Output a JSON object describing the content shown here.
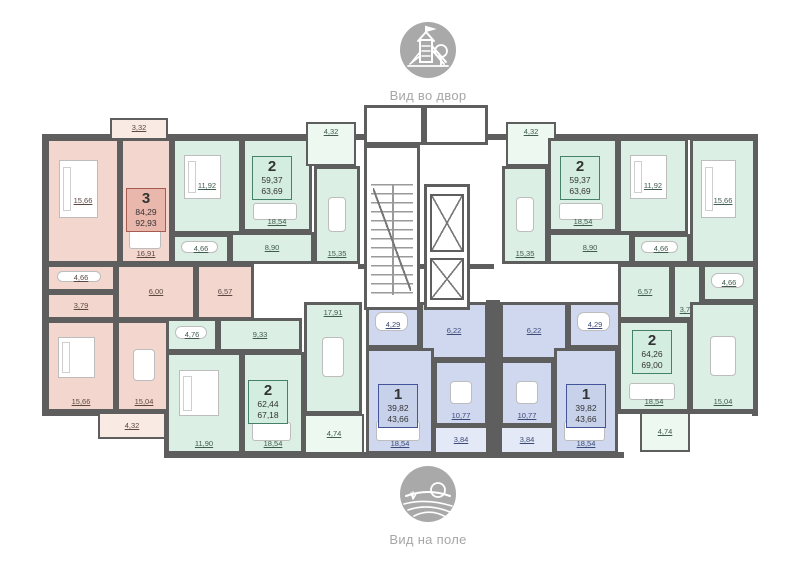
{
  "header_icon": {
    "caption": "Вид во двор"
  },
  "footer_icon": {
    "caption": "Вид на поле"
  },
  "wall_color": "#5e5e5e",
  "palettes": {
    "pink": {
      "room": "#f3d7ce",
      "balcony": "#f9eae4",
      "box_fill": "#e9b7ab",
      "box_border": "#a55c4f",
      "text": "#5c4742"
    },
    "green": {
      "room": "#dcefe4",
      "balcony": "#edf8f1",
      "box_fill": "#d3edе0",
      "box_fill2": "#d3ede0",
      "box_border": "#44806a",
      "text": "#3f5c50"
    },
    "blue": {
      "room": "#cfd8ee",
      "balcony": "#e3e9f6",
      "box_fill": "#c7d2ea",
      "box_border": "#44549a",
      "text": "#3c4a78"
    }
  },
  "apartments": [
    {
      "id": "apt-3-left",
      "type": "3",
      "area_living": "84,29",
      "area_total": "92,93",
      "palette": "pink",
      "info_box": {
        "x": 126,
        "y": 188
      },
      "rooms": [
        {
          "area": "3,32",
          "x": 110,
          "y": 118,
          "w": 58,
          "h": 24,
          "balcony": true,
          "lp": "t"
        },
        {
          "area": "15,66",
          "x": 46,
          "y": 138,
          "w": 74,
          "h": 126,
          "furn": "bed",
          "lp": "m"
        },
        {
          "area": "16,91",
          "x": 120,
          "y": 138,
          "w": 52,
          "h": 126,
          "furn": "sofa",
          "lp": "b"
        },
        {
          "area": "4,66",
          "x": 46,
          "y": 264,
          "w": 70,
          "h": 28,
          "furn": "tub",
          "lp": "m"
        },
        {
          "area": "3,79",
          "x": 46,
          "y": 292,
          "w": 70,
          "h": 28,
          "lp": "m"
        },
        {
          "area": "6,00",
          "x": 116,
          "y": 264,
          "w": 80,
          "h": 56,
          "lp": "m"
        },
        {
          "area": "6,57",
          "x": 196,
          "y": 264,
          "w": 58,
          "h": 56,
          "lp": "m"
        },
        {
          "area": "15,66",
          "x": 46,
          "y": 320,
          "w": 70,
          "h": 92,
          "furn": "bed",
          "lp": "b"
        },
        {
          "area": "15,04",
          "x": 116,
          "y": 320,
          "w": 56,
          "h": 92,
          "furn": "table",
          "lp": "b"
        },
        {
          "area": "4,32",
          "x": 98,
          "y": 412,
          "w": 68,
          "h": 27,
          "balcony": true,
          "lp": "m"
        }
      ]
    },
    {
      "id": "apt-2-top-left",
      "type": "2",
      "area_living": "59,37",
      "area_total": "63,69",
      "palette": "green",
      "info_box": {
        "x": 252,
        "y": 156
      },
      "rooms": [
        {
          "area": "11,92",
          "x": 172,
          "y": 138,
          "w": 70,
          "h": 96,
          "furn": "bed",
          "lp": "m"
        },
        {
          "area": "4,66",
          "x": 172,
          "y": 234,
          "w": 58,
          "h": 30,
          "furn": "tub",
          "lp": "m"
        },
        {
          "area": "18,54",
          "x": 242,
          "y": 138,
          "w": 70,
          "h": 94,
          "furn": "sofa",
          "lp": "b"
        },
        {
          "area": "8,90",
          "x": 230,
          "y": 232,
          "w": 84,
          "h": 32,
          "lp": "m"
        },
        {
          "area": "15,35",
          "x": 314,
          "y": 166,
          "w": 46,
          "h": 98,
          "furn": "table",
          "lp": "b"
        },
        {
          "area": "4,32",
          "x": 306,
          "y": 122,
          "w": 50,
          "h": 44,
          "balcony": true,
          "lp": "t"
        }
      ]
    },
    {
      "id": "apt-2-bottom-left",
      "type": "2",
      "area_living": "62,44",
      "area_total": "67,18",
      "palette": "green",
      "info_box": {
        "x": 248,
        "y": 380
      },
      "rooms": [
        {
          "area": "4,76",
          "x": 166,
          "y": 318,
          "w": 52,
          "h": 34,
          "furn": "tub",
          "lp": "m"
        },
        {
          "area": "9,33",
          "x": 218,
          "y": 318,
          "w": 84,
          "h": 34,
          "lp": "m"
        },
        {
          "area": "11,90",
          "x": 166,
          "y": 352,
          "w": 76,
          "h": 102,
          "furn": "bed",
          "lp": "b"
        },
        {
          "area": "18,54",
          "x": 242,
          "y": 352,
          "w": 62,
          "h": 102,
          "furn": "sofa",
          "lp": "b"
        },
        {
          "area": "17,91",
          "x": 304,
          "y": 302,
          "w": 58,
          "h": 112,
          "furn": "table",
          "lp": "t"
        },
        {
          "area": "4,74",
          "x": 304,
          "y": 414,
          "w": 60,
          "h": 40,
          "balcony": true,
          "lp": "m"
        }
      ]
    },
    {
      "id": "apt-1-left",
      "type": "1",
      "area_living": "39,82",
      "area_total": "43,66",
      "palette": "blue",
      "info_box": {
        "x": 378,
        "y": 384
      },
      "rooms": [
        {
          "area": "4,29",
          "x": 366,
          "y": 302,
          "w": 54,
          "h": 46,
          "furn": "tub",
          "lp": "m"
        },
        {
          "area": "6,22",
          "x": 420,
          "y": 302,
          "w": 68,
          "h": 58,
          "lp": "m"
        },
        {
          "area": "18,54",
          "x": 366,
          "y": 348,
          "w": 68,
          "h": 106,
          "furn": "sofa",
          "lp": "b"
        },
        {
          "area": "10,77",
          "x": 434,
          "y": 360,
          "w": 54,
          "h": 66,
          "furn": "table",
          "lp": "b"
        },
        {
          "area": "3,84",
          "x": 434,
          "y": 426,
          "w": 54,
          "h": 28,
          "balcony": true,
          "lp": "m"
        }
      ]
    },
    {
      "id": "apt-1-right",
      "type": "1",
      "area_living": "39,82",
      "area_total": "43,66",
      "palette": "blue",
      "info_box": {
        "x": 566,
        "y": 384
      },
      "rooms": [
        {
          "area": "6,22",
          "x": 500,
          "y": 302,
          "w": 68,
          "h": 58,
          "lp": "m"
        },
        {
          "area": "4,29",
          "x": 568,
          "y": 302,
          "w": 54,
          "h": 46,
          "furn": "tub",
          "lp": "m"
        },
        {
          "area": "10,77",
          "x": 500,
          "y": 360,
          "w": 54,
          "h": 66,
          "furn": "table",
          "lp": "b"
        },
        {
          "area": "18,54",
          "x": 554,
          "y": 348,
          "w": 64,
          "h": 106,
          "furn": "sofa",
          "lp": "b"
        },
        {
          "area": "3,84",
          "x": 500,
          "y": 426,
          "w": 54,
          "h": 28,
          "balcony": true,
          "lp": "m"
        }
      ]
    },
    {
      "id": "apt-2-top-right",
      "type": "2",
      "area_living": "59,37",
      "area_total": "63,69",
      "palette": "green",
      "info_box": {
        "x": 560,
        "y": 156
      },
      "rooms": [
        {
          "area": "4,32",
          "x": 506,
          "y": 122,
          "w": 50,
          "h": 44,
          "balcony": true,
          "lp": "t"
        },
        {
          "area": "15,35",
          "x": 502,
          "y": 166,
          "w": 46,
          "h": 98,
          "furn": "table",
          "lp": "b"
        },
        {
          "area": "18,54",
          "x": 548,
          "y": 138,
          "w": 70,
          "h": 94,
          "furn": "sofa",
          "lp": "b"
        },
        {
          "area": "8,90",
          "x": 548,
          "y": 232,
          "w": 84,
          "h": 32,
          "lp": "m"
        },
        {
          "area": "11,92",
          "x": 618,
          "y": 138,
          "w": 70,
          "h": 96,
          "furn": "bed",
          "lp": "m"
        },
        {
          "area": "4,66",
          "x": 632,
          "y": 234,
          "w": 58,
          "h": 30,
          "furn": "tub",
          "lp": "m"
        }
      ]
    },
    {
      "id": "apt-2-right",
      "type": "2",
      "area_living": "64,26",
      "area_total": "69,00",
      "palette": "green",
      "info_box": {
        "x": 632,
        "y": 330
      },
      "rooms": [
        {
          "area": "15,66",
          "x": 690,
          "y": 138,
          "w": 66,
          "h": 126,
          "furn": "bed",
          "lp": "m"
        },
        {
          "area": "4,66",
          "x": 702,
          "y": 264,
          "w": 54,
          "h": 38,
          "furn": "tub",
          "lp": "m"
        },
        {
          "area": "3,79",
          "x": 672,
          "y": 264,
          "w": 30,
          "h": 56,
          "lp": "b"
        },
        {
          "area": "6,57",
          "x": 618,
          "y": 264,
          "w": 54,
          "h": 56,
          "lp": "m"
        },
        {
          "area": "18,54",
          "x": 618,
          "y": 320,
          "w": 72,
          "h": 92,
          "furn": "sofa",
          "lp": "b"
        },
        {
          "area": "15,04",
          "x": 690,
          "y": 302,
          "w": 66,
          "h": 110,
          "furn": "table",
          "lp": "b"
        },
        {
          "area": "4,74",
          "x": 640,
          "y": 412,
          "w": 50,
          "h": 40,
          "balcony": true,
          "lp": "m"
        }
      ]
    }
  ],
  "core": {
    "vestibules": [
      {
        "x": 364,
        "y": 105,
        "w": 60,
        "h": 40
      },
      {
        "x": 424,
        "y": 105,
        "w": 64,
        "h": 40
      }
    ],
    "stair": {
      "x": 364,
      "y": 145,
      "w": 56,
      "h": 165
    },
    "lift_shaft": {
      "x": 424,
      "y": 184,
      "w": 46,
      "h": 126
    },
    "lifts": [
      {
        "x": 430,
        "y": 194,
        "w": 34,
        "h": 58
      },
      {
        "x": 430,
        "y": 258,
        "w": 34,
        "h": 42
      }
    ]
  },
  "walls": [
    {
      "x": 42,
      "y": 134,
      "w": 716,
      "h": 6
    },
    {
      "x": 42,
      "y": 134,
      "w": 6,
      "h": 282
    },
    {
      "x": 752,
      "y": 134,
      "w": 6,
      "h": 282
    },
    {
      "x": 42,
      "y": 410,
      "w": 128,
      "h": 6
    },
    {
      "x": 164,
      "y": 410,
      "w": 6,
      "h": 48
    },
    {
      "x": 164,
      "y": 452,
      "w": 460,
      "h": 6
    },
    {
      "x": 616,
      "y": 408,
      "w": 142,
      "h": 6
    },
    {
      "x": 486,
      "y": 300,
      "w": 14,
      "h": 158
    },
    {
      "x": 358,
      "y": 264,
      "w": 136,
      "h": 5
    }
  ]
}
